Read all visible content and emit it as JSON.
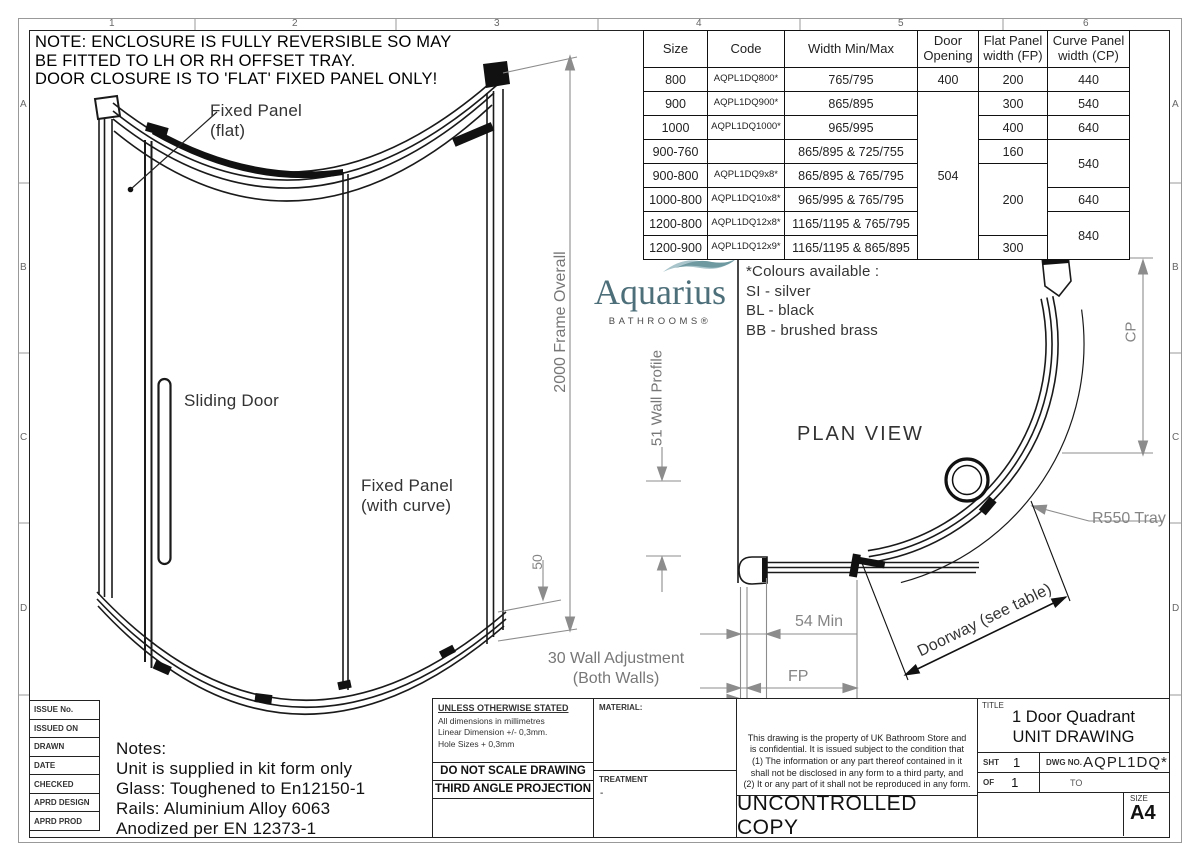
{
  "colors": {
    "line": "#1a1a1a",
    "dimension_gray": "#8c8c8c",
    "logo_teal": "#4d6f7a",
    "logo_wave_light": "#a9c5cb",
    "logo_wave_dark": "#6e99a1"
  },
  "sheet": {
    "zones_top": [
      "1",
      "2",
      "3",
      "4",
      "5",
      "6"
    ],
    "zones_side": [
      "A",
      "B",
      "C",
      "D"
    ],
    "note": "NOTE: ENCLOSURE IS FULLY REVERSIBLE SO MAY\nBE FITTED TO LH OR RH OFFSET TRAY.\nDOOR CLOSURE IS TO 'FLAT' FIXED PANEL ONLY!"
  },
  "logo": {
    "name": "Aquarius",
    "tagline": "BATHROOMS®"
  },
  "elevation": {
    "fixed_panel_flat": "Fixed Panel\n(flat)",
    "sliding_door": "Sliding Door",
    "fixed_panel_curve": "Fixed Panel\n(with curve)",
    "frame_overall": "2000 Frame Overall",
    "dim_50": "50",
    "wall_profile": "51 Wall Profile",
    "wall_adjustment": "30 Wall Adjustment\n(Both Walls)"
  },
  "plan": {
    "title": "PLAN VIEW",
    "colours": "*Colours available :\nSI - silver\nBL - black\nBB - brushed brass",
    "min_54": "54 Min",
    "fp": "FP",
    "cp": "CP",
    "r550": "R550 Tray",
    "doorway": "Doorway (see table)"
  },
  "table": {
    "headers": [
      "Size",
      "Code",
      "Width Min/Max",
      "Door Opening",
      "Flat Panel width (FP)",
      "Curve Panel width (CP)"
    ],
    "rows": [
      {
        "size": "800",
        "code": "AQPL1DQ800*",
        "width": "765/795",
        "door": "400",
        "fp": "200",
        "cp": "440"
      },
      {
        "size": "900",
        "code": "AQPL1DQ900*",
        "width": "865/895",
        "door": "504",
        "fp": "300",
        "cp": "540"
      },
      {
        "size": "1000",
        "code": "AQPL1DQ1000*",
        "width": "965/995",
        "fp": "400",
        "cp": "640"
      },
      {
        "size": "900-760",
        "code": "",
        "width": "865/895 & 725/755",
        "fp": "160",
        "cp": "540"
      },
      {
        "size": "900-800",
        "code": "AQPL1DQ9x8*",
        "width": "865/895 & 765/795",
        "fp": "200"
      },
      {
        "size": "1000-800",
        "code": "AQPL1DQ10x8*",
        "width": "965/995 & 765/795",
        "cp": "640"
      },
      {
        "size": "1200-800",
        "code": "AQPL1DQ12x8*",
        "width": "1165/1195 & 765/795",
        "cp": "840"
      },
      {
        "size": "1200-900",
        "code": "AQPL1DQ12x9*",
        "width": "1165/1195 & 865/895",
        "fp": "300"
      }
    ]
  },
  "titleblock": {
    "issue_rows": [
      "ISSUE No.",
      "ISSUED ON",
      "DRAWN",
      "DATE",
      "CHECKED",
      "APRD DESIGN",
      "APRD PROD"
    ],
    "notes": "Notes:\nUnit is supplied in kit form only\nGlass: Toughened to En12150-1\nRails: Aluminium Alloy 6063\nAnodized per EN 12373-1",
    "tolerance_title": "UNLESS OTHERWISE STATED",
    "tolerance_body": "All dimensions in millimetres\nLinear Dimension +/- 0,3mm.\nHole Sizes + 0,3mm",
    "do_not_scale": "DO NOT SCALE DRAWING",
    "third_angle": "THIRD ANGLE PROJECTION",
    "material_label": "MATERIAL:",
    "treatment_label": "TREATMENT",
    "treatment_value": "-",
    "disclaimer": "This drawing is the property of UK Bathroom Store and\nis confidential. It is issued subject to the condition that\n(1) The information or any part thereof contained in it\nshall not be disclosed in any form to a third party, and\n(2) It or any part of it shall not be reproduced in any form.",
    "uncontrolled": "UNCONTROLLED COPY",
    "title_label": "TITLE",
    "title": "1 Door Quadrant\nUNIT DRAWING",
    "sht_label": "SHT",
    "sht_value": "1",
    "dwg_label": "DWG NO.",
    "dwg_value": "AQPL1DQ*",
    "of_label": "OF",
    "of_value": "1",
    "to_label": "TO",
    "size_label": "SIZE",
    "size_value": "A4"
  }
}
